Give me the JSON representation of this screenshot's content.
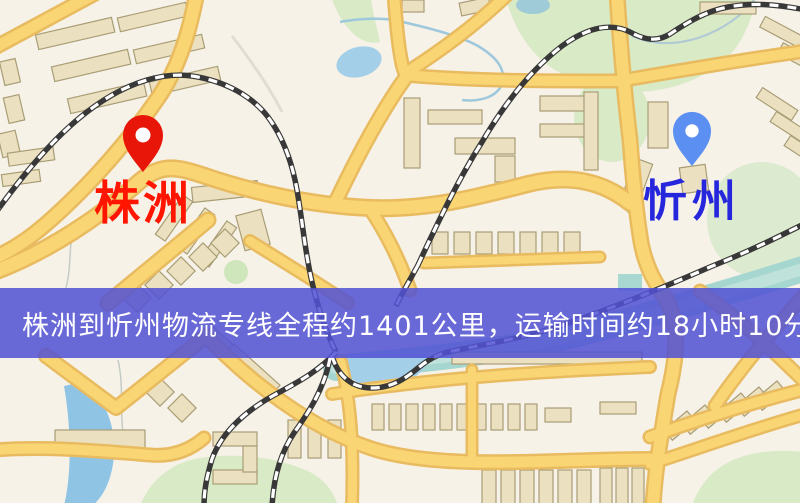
{
  "banner": {
    "text": "株洲到忻州物流专线全程约1401公里，运输时间约18小时10分钟.",
    "background_color": "rgba(82,82,212,0.86)",
    "text_color": "#ffffff"
  },
  "markers": {
    "origin": {
      "label": "株洲",
      "pin_color": "#e81509",
      "label_color": "#ff1500"
    },
    "destination": {
      "label": "忻州",
      "pin_color": "#5b8ff2",
      "label_color": "#2626dd"
    }
  },
  "map_colors": {
    "background": "#f7f2e8",
    "road_fill": "#f9d673",
    "road_casing": "#e9bb60",
    "building": "#ebe1c1",
    "green_area": "#d9eac7",
    "water": "#a3cfe8",
    "river": "#a6d6d0",
    "railway": "#383838"
  }
}
